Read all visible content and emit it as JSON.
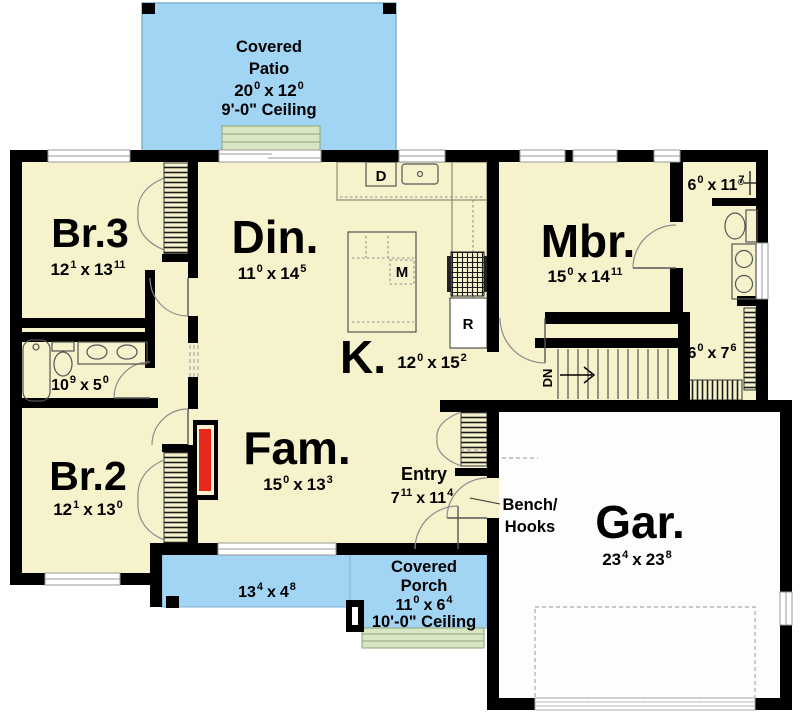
{
  "sep": "x",
  "palette": {
    "floor": "#f6f2cc",
    "patio": "#a2d4f3",
    "patio_border": "#7fb2d4",
    "steps": "#d8e6c3",
    "steps_border": "#8fa37a",
    "wall": "#000000",
    "fireplace_red": "#e8271d",
    "garage_floor": "#fdfdfc"
  },
  "areas": {
    "patio": {
      "line1": "Covered",
      "line2": "Patio",
      "a": "20",
      "as": "0",
      "b": "12",
      "bs": "0",
      "ceiling": "9'-0\" Ceiling"
    },
    "porch": {
      "line1": "Covered",
      "line2": "Porch",
      "a": "11",
      "as": "0",
      "b": "6",
      "bs": "4",
      "ceiling": "10'-0\" Ceiling"
    },
    "porch_left": {
      "a": "13",
      "as": "4",
      "b": "4",
      "bs": "8"
    }
  },
  "rooms": {
    "br3": {
      "name": "Br.3",
      "a": "12",
      "as": "1",
      "b": "13",
      "bs": "11"
    },
    "din": {
      "name": "Din.",
      "a": "11",
      "as": "0",
      "b": "14",
      "bs": "5"
    },
    "mbr": {
      "name": "Mbr.",
      "a": "15",
      "as": "0",
      "b": "14",
      "bs": "11"
    },
    "mbath": {
      "a": "6",
      "as": "0",
      "b": "11",
      "bs": "7"
    },
    "hallbath": {
      "a": "10",
      "as": "9",
      "b": "5",
      "bs": "0"
    },
    "kitchen": {
      "name": "K.",
      "a": "12",
      "as": "0",
      "b": "15",
      "bs": "2"
    },
    "wic": {
      "a": "6",
      "as": "0",
      "b": "7",
      "bs": "6"
    },
    "br2": {
      "name": "Br.2",
      "a": "12",
      "as": "1",
      "b": "13",
      "bs": "0"
    },
    "fam": {
      "name": "Fam.",
      "a": "15",
      "as": "0",
      "b": "13",
      "bs": "3"
    },
    "entry": {
      "name": "Entry",
      "a": "7",
      "as": "11",
      "b": "11",
      "bs": "4"
    },
    "gar": {
      "name": "Gar.",
      "a": "23",
      "as": "4",
      "b": "23",
      "bs": "8"
    }
  },
  "labels": {
    "dishwasher": "D",
    "microwave": "M",
    "range": "R",
    "down": "DN",
    "bench1": "Bench/",
    "bench2": "Hooks"
  }
}
